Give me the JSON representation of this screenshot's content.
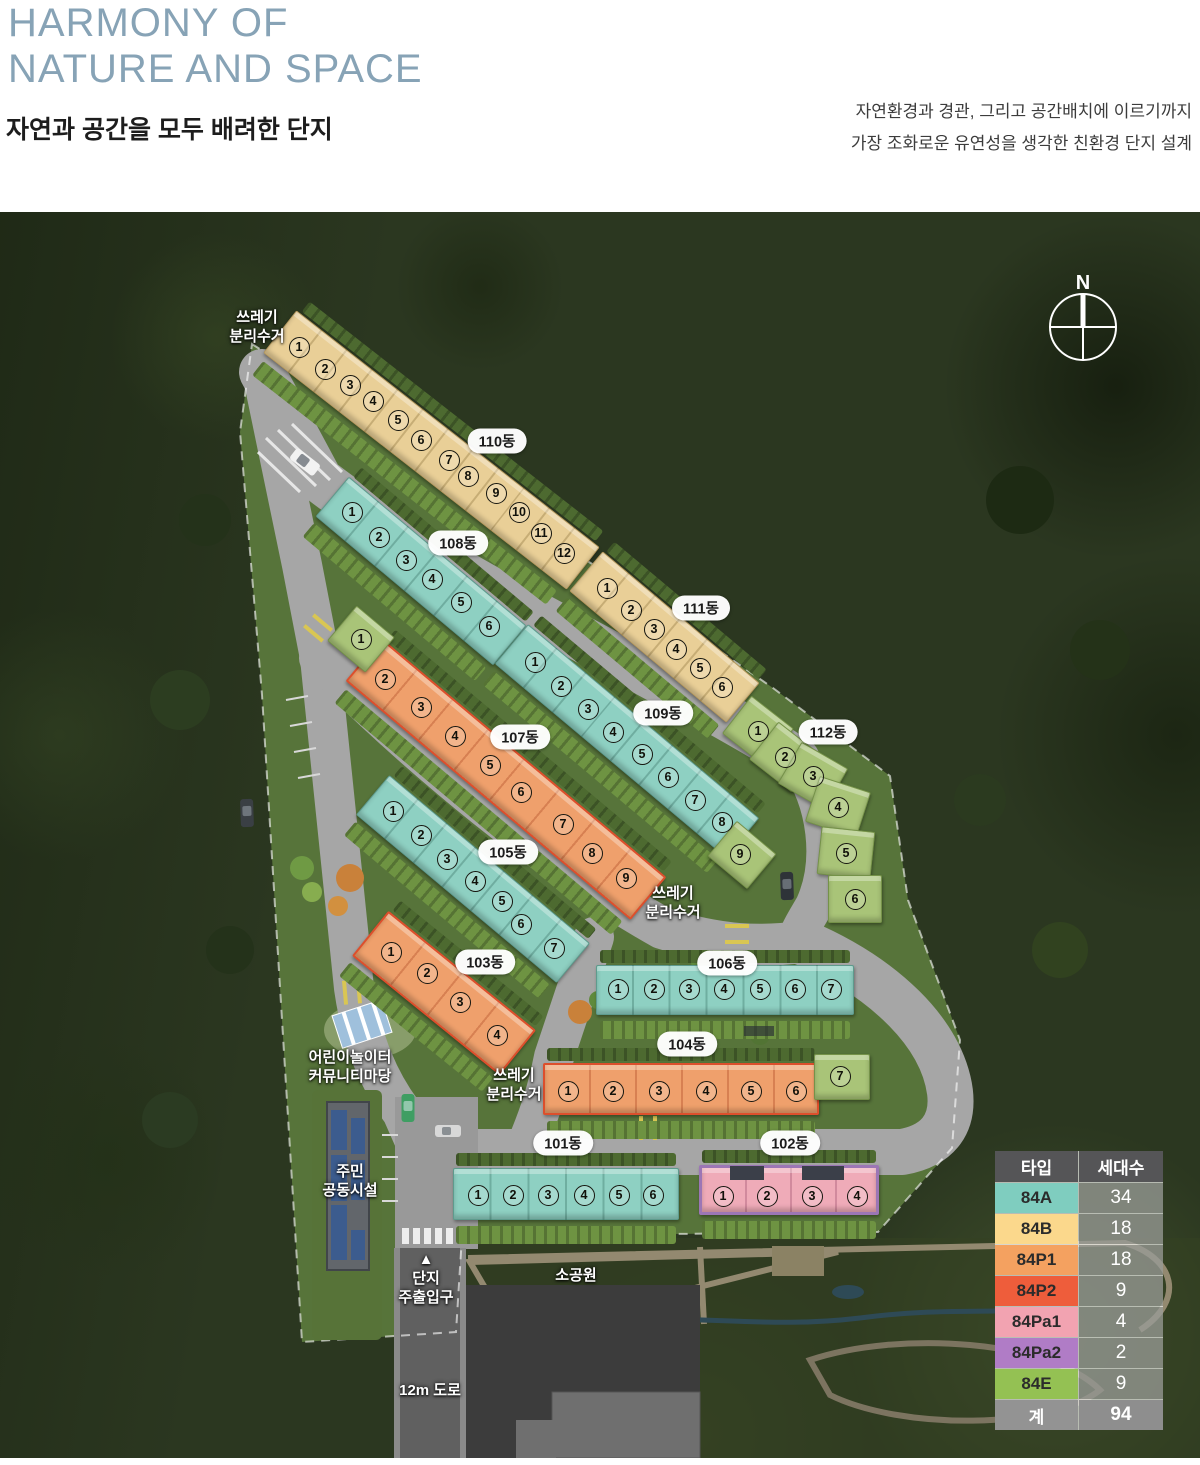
{
  "header": {
    "title": "HARMONY OF\nNATURE AND SPACE",
    "subtitle": "자연과 공간을 모두 배려한 단지",
    "description": "자연환경과 경관, 그리고 공간배치에 이르기까지\n가장 조화로운 유연성을 생각한 친환경 단지 설계",
    "title_color": "#87a3b6"
  },
  "compass": {
    "label": "N"
  },
  "legend": {
    "headers": [
      "타입",
      "세대수"
    ],
    "rows": [
      {
        "type": "84A",
        "count": "34",
        "color": "#7fcdbf"
      },
      {
        "type": "84B",
        "count": "18",
        "color": "#fbd88c"
      },
      {
        "type": "84P1",
        "count": "18",
        "color": "#f4a160"
      },
      {
        "type": "84P2",
        "count": "9",
        "color": "#ee5d3b"
      },
      {
        "type": "84Pa1",
        "count": "4",
        "color": "#f2a3b1"
      },
      {
        "type": "84Pa2",
        "count": "2",
        "color": "#b07cc6"
      },
      {
        "type": "84E",
        "count": "9",
        "color": "#94c153"
      }
    ],
    "total": {
      "type": "계",
      "count": "94"
    }
  },
  "map": {
    "type_colors": {
      "A": {
        "fill": "#8ed0c2",
        "edge": "rgba(35,90,78,.45)",
        "stripe": "rgba(20,70,60,.25)"
      },
      "B": {
        "fill": "#e9cf97",
        "edge": "rgba(130,100,40,.5)",
        "stripe": "rgba(110,85,30,.28)"
      },
      "P1": {
        "fill": "#efa06c",
        "edge": "#dd4f2c",
        "stripe": "rgba(160,55,20,.30)"
      },
      "Pa": {
        "fill": "#efabb8",
        "edge": "#9c76b5",
        "stripe": "rgba(140,60,95,.30)"
      },
      "E": {
        "fill": "#a9c478",
        "edge": "rgba(75,105,35,.55)",
        "stripe": "rgba(55,85,20,.30)"
      }
    },
    "buildings": [
      {
        "id": "110",
        "label": "110동",
        "type": "B",
        "label_x": 497,
        "label_y": 441,
        "segs": [
          {
            "x": 431,
            "y": 450,
            "len": 385,
            "w": 54,
            "a": 38,
            "n": 12
          }
        ],
        "units": [
          [
            1,
            299,
            347
          ],
          [
            2,
            325,
            369
          ],
          [
            3,
            350,
            385
          ],
          [
            4,
            373,
            401
          ],
          [
            5,
            398,
            420
          ],
          [
            6,
            421,
            440
          ],
          [
            7,
            449,
            460
          ],
          [
            8,
            468,
            476
          ],
          [
            9,
            496,
            493
          ],
          [
            10,
            519,
            512
          ],
          [
            11,
            541,
            533
          ],
          [
            12,
            564,
            553
          ]
        ]
      },
      {
        "id": "108",
        "label": "108동",
        "type": "A",
        "label_x": 458,
        "label_y": 543,
        "segs": [
          {
            "x": 421,
            "y": 571,
            "len": 232,
            "w": 52,
            "a": 40,
            "n": 6
          }
        ],
        "units": [
          [
            1,
            352,
            512
          ],
          [
            2,
            379,
            537
          ],
          [
            3,
            406,
            560
          ],
          [
            4,
            432,
            579
          ],
          [
            5,
            461,
            602
          ],
          [
            6,
            489,
            626
          ]
        ]
      },
      {
        "id": "111",
        "label": "111동",
        "type": "B",
        "label_x": 701,
        "label_y": 608,
        "segs": [
          {
            "x": 664,
            "y": 637,
            "len": 205,
            "w": 52,
            "a": 40,
            "n": 6
          }
        ],
        "units": [
          [
            1,
            607,
            588
          ],
          [
            2,
            631,
            610
          ],
          [
            3,
            654,
            629
          ],
          [
            4,
            676,
            649
          ],
          [
            5,
            700,
            668
          ],
          [
            6,
            722,
            687
          ]
        ]
      },
      {
        "id": "107",
        "label": "107동",
        "type": "P1",
        "label_x": 520,
        "label_y": 737,
        "segs": [
          {
            "x": 506,
            "y": 779,
            "len": 372,
            "w": 56,
            "a": 40,
            "n": 8
          },
          {
            "x": 361,
            "y": 639,
            "len": 50,
            "w": 46,
            "a": 40,
            "t": "E"
          }
        ],
        "units": [
          [
            1,
            361,
            639
          ],
          [
            2,
            385,
            679
          ],
          [
            3,
            421,
            707
          ],
          [
            4,
            455,
            736
          ],
          [
            5,
            490,
            765
          ],
          [
            6,
            521,
            792
          ],
          [
            7,
            563,
            824
          ],
          [
            8,
            592,
            853
          ],
          [
            9,
            626,
            878
          ]
        ]
      },
      {
        "id": "109",
        "label": "109동",
        "type": "A",
        "label_x": 663,
        "label_y": 713,
        "segs": [
          {
            "x": 627,
            "y": 741,
            "len": 302,
            "w": 52,
            "a": 40,
            "n": 8
          },
          {
            "x": 742,
            "y": 855,
            "len": 52,
            "w": 46,
            "a": 40,
            "t": "E"
          }
        ],
        "units": [
          [
            1,
            535,
            662
          ],
          [
            2,
            561,
            686
          ],
          [
            3,
            588,
            709
          ],
          [
            4,
            613,
            732
          ],
          [
            5,
            642,
            754
          ],
          [
            6,
            668,
            777
          ],
          [
            7,
            695,
            800
          ],
          [
            8,
            722,
            822
          ],
          [
            9,
            740,
            854
          ]
        ]
      },
      {
        "id": "112",
        "label": "112동",
        "type": "E",
        "label_x": 828,
        "label_y": 732,
        "hedge": false,
        "segs": [
          {
            "x": 758,
            "y": 731,
            "len": 54,
            "w": 48,
            "a": 38
          },
          {
            "x": 785,
            "y": 757,
            "len": 54,
            "w": 48,
            "a": 38
          },
          {
            "x": 813,
            "y": 776,
            "len": 54,
            "w": 48,
            "a": 30
          },
          {
            "x": 838,
            "y": 807,
            "len": 54,
            "w": 48,
            "a": 18
          },
          {
            "x": 846,
            "y": 853,
            "len": 54,
            "w": 48,
            "a": 6
          },
          {
            "x": 855,
            "y": 899,
            "len": 54,
            "w": 48,
            "a": 0
          }
        ],
        "units": [
          [
            1,
            758,
            731
          ],
          [
            2,
            785,
            757
          ],
          [
            3,
            813,
            776
          ],
          [
            4,
            838,
            807
          ],
          [
            5,
            846,
            853
          ],
          [
            6,
            855,
            899
          ]
        ]
      },
      {
        "id": "105",
        "label": "105동",
        "type": "A",
        "label_x": 508,
        "label_y": 852,
        "segs": [
          {
            "x": 473,
            "y": 879,
            "len": 262,
            "w": 52,
            "a": 40,
            "n": 7
          }
        ],
        "units": [
          [
            1,
            393,
            811
          ],
          [
            2,
            421,
            835
          ],
          [
            3,
            447,
            859
          ],
          [
            4,
            475,
            881
          ],
          [
            5,
            502,
            901
          ],
          [
            6,
            521,
            924
          ],
          [
            7,
            554,
            948
          ]
        ]
      },
      {
        "id": "103",
        "label": "103동",
        "type": "P1",
        "label_x": 485,
        "label_y": 962,
        "segs": [
          {
            "x": 444,
            "y": 993,
            "len": 190,
            "w": 58,
            "a": 39,
            "n": 4
          }
        ],
        "units": [
          [
            1,
            391,
            952
          ],
          [
            2,
            427,
            973
          ],
          [
            3,
            460,
            1002
          ],
          [
            4,
            497,
            1035
          ]
        ]
      },
      {
        "id": "106",
        "label": "106동",
        "type": "A",
        "label_x": 727,
        "label_y": 963,
        "segs": [
          {
            "x": 725,
            "y": 990,
            "len": 258,
            "w": 50,
            "a": 0,
            "n": 7
          }
        ],
        "units": [
          [
            1,
            618,
            989
          ],
          [
            2,
            654,
            989
          ],
          [
            3,
            689,
            989
          ],
          [
            4,
            724,
            989
          ],
          [
            5,
            760,
            989
          ],
          [
            6,
            795,
            989
          ],
          [
            7,
            831,
            989
          ]
        ]
      },
      {
        "id": "104",
        "label": "104동",
        "type": "P1",
        "label_x": 687,
        "label_y": 1044,
        "segs": [
          {
            "x": 681,
            "y": 1089,
            "len": 276,
            "w": 52,
            "a": 0,
            "n": 6
          },
          {
            "x": 842,
            "y": 1077,
            "len": 56,
            "w": 46,
            "a": 0,
            "t": "E"
          }
        ],
        "units": [
          [
            1,
            568,
            1091
          ],
          [
            2,
            613,
            1091
          ],
          [
            3,
            659,
            1091
          ],
          [
            4,
            706,
            1091
          ],
          [
            5,
            751,
            1091
          ],
          [
            6,
            796,
            1091
          ],
          [
            7,
            840,
            1076
          ]
        ]
      },
      {
        "id": "101",
        "label": "101동",
        "type": "A",
        "label_x": 563,
        "label_y": 1143,
        "segs": [
          {
            "x": 566,
            "y": 1194,
            "len": 226,
            "w": 52,
            "a": 0,
            "n": 6
          }
        ],
        "units": [
          [
            1,
            478,
            1195
          ],
          [
            2,
            513,
            1195
          ],
          [
            3,
            548,
            1195
          ],
          [
            4,
            584,
            1195
          ],
          [
            5,
            619,
            1195
          ],
          [
            6,
            653,
            1195
          ]
        ]
      },
      {
        "id": "102",
        "label": "102동",
        "type": "Pa",
        "label_x": 790,
        "label_y": 1143,
        "segs": [
          {
            "x": 789,
            "y": 1190,
            "len": 180,
            "w": 50,
            "a": 0,
            "n": 4
          }
        ],
        "units": [
          [
            1,
            723,
            1196
          ],
          [
            2,
            767,
            1196
          ],
          [
            3,
            812,
            1196
          ],
          [
            4,
            857,
            1196
          ]
        ]
      }
    ],
    "labels": [
      {
        "id": "waste-1",
        "text": "쓰레기\n분리수거",
        "x": 257,
        "y": 308
      },
      {
        "id": "waste-2",
        "text": "쓰레기\n분리수거",
        "x": 673,
        "y": 884
      },
      {
        "id": "waste-3",
        "text": "쓰레기\n분리수거",
        "x": 514,
        "y": 1066
      },
      {
        "id": "playground",
        "text": "어린이놀이터\n커뮤니티마당",
        "x": 350,
        "y": 1048
      },
      {
        "id": "community",
        "text": "주민\n공동시설",
        "x": 350,
        "y": 1162
      },
      {
        "id": "entrance",
        "text": "▲\n단지\n주출입구",
        "x": 426,
        "y": 1250
      },
      {
        "id": "small-park",
        "text": "소공원",
        "x": 576,
        "y": 1266
      },
      {
        "id": "road-12m",
        "text": "12m 도로",
        "x": 430,
        "y": 1381
      }
    ],
    "deco_blocks": [
      {
        "x": 730,
        "y": 1166,
        "w": 34,
        "h": 14,
        "c": "#3b3f49",
        "name": "roof-block"
      },
      {
        "x": 802,
        "y": 1166,
        "w": 42,
        "h": 14,
        "c": "#3b3f49",
        "name": "roof-block"
      },
      {
        "x": 744,
        "y": 1026,
        "w": 30,
        "h": 10,
        "c": "rgba(40,44,52,.65)",
        "name": "roof-block"
      }
    ]
  }
}
